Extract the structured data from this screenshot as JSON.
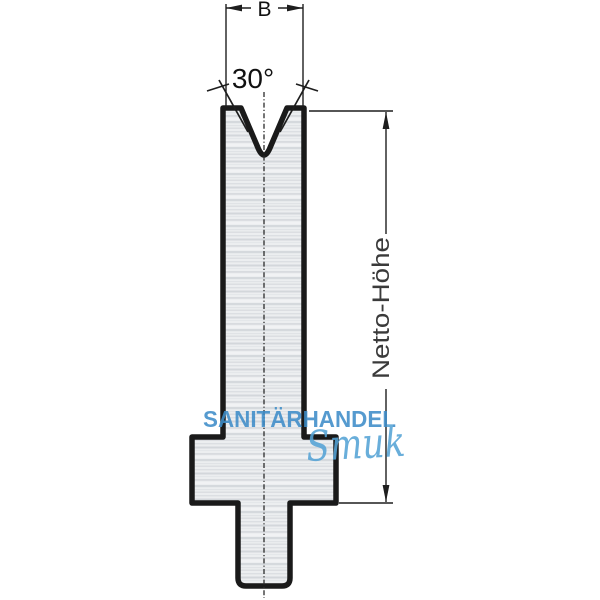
{
  "drawing": {
    "dimension_width_label": "B",
    "dimension_angle_label": "30°",
    "dimension_height_label": "Netto-Höhe"
  },
  "watermark": {
    "line1": "SANITÄRHANDEL",
    "line2": "Smuk",
    "color_line1": "#3e8dc9",
    "color_line2": "#55a3d6"
  },
  "colors": {
    "outline": "#1a1a1a",
    "dimension_lines": "#1e1e1e",
    "dimension_text": "#3a3a3a",
    "body_fill_base": "#eceef0"
  }
}
